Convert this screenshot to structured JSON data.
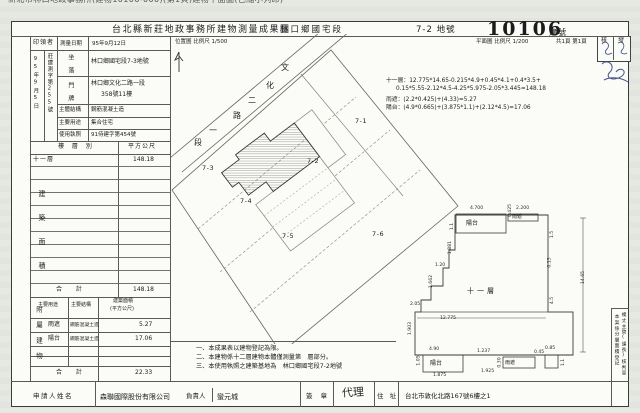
{
  "watermark": "新北市林口地政事務所(建物10106-000)(第1頁)建物平面圖(已縮小列印)",
  "header": {
    "title": "台北縣新莊地政事務所建物測量成果圖",
    "section": "林口鄉國宅段",
    "lot": "7-2 地號",
    "building_no": "10106",
    "building_no_label": "建號"
  },
  "map": {
    "scale_site": "位置圖 比例尺 1/500",
    "scale_plan": "平面圖 比例尺 1/200",
    "pages": "共1頁 第1頁",
    "stamp_left": "核",
    "stamp_right": "發",
    "north_icon": "north-arrow"
  },
  "info": {
    "recipient_label": "印領者",
    "survey_date_label": "測量日期",
    "survey_date": "95年9月12日",
    "receive_date": "95年9月5日",
    "case_no": "莊建測字第255號",
    "site_label": "坐 落",
    "site_value": "林口鄉國宅段7-3地號",
    "addr_label": "門 牌",
    "addr_value1": "林口鄉文化二路一段",
    "addr_value2": "358號11樓",
    "struct_label": "主體結構",
    "struct_value": "鋼筋混凝土造",
    "use_label": "主要用途",
    "use_value": "集合住宅",
    "lic_label": "使用執照",
    "lic_value": "91侍建字第454號"
  },
  "floor_table": {
    "side_label": "建築面積",
    "col_floor": "樓 層 別",
    "col_area": "平方公尺",
    "row_floor": "十一層",
    "row_area": "148.18",
    "total_label": "合 計",
    "total_area": "148.18"
  },
  "annex_table": {
    "side_label": "附屬建物",
    "col_use": "主要用途",
    "col_struct": "主要結構",
    "col_area_1": "建築面積",
    "col_area_2": "(平方公尺)",
    "rows": [
      {
        "use": "雨遮",
        "struct": "鋼筋混凝土造",
        "area": "5.27"
      },
      {
        "use": "陽台",
        "struct": "鋼筋混凝土造",
        "area": "17.06"
      }
    ],
    "total_label": "合 計",
    "total_area": "22.33"
  },
  "formulas": {
    "l1": "十一層：12.775*14.65-0.215*4.9+0.45*4.1+0.4*3.5+",
    "l2": "0.15*5.55-2.12*4.5-4.25*5.975-2.05*3.445=148.18",
    "l3": "雨遮：(2.2*0.425)+(4.33)=5.27",
    "l4": "陽台：(4.9*0.665)+(3.875*1.1)+(2.12*4.5)=17.06"
  },
  "notes": [
    "一、本成果表以建物登記為限。",
    "二、本建物係十二層建物本體僅測量第　層部分。",
    "三、本使用執照之建築基地為　林口鄉國宅段7-2地號"
  ],
  "applicant": {
    "name_label": "申請人姓名",
    "company": "森聯國際股份有限公司",
    "principal_label": "負責人",
    "principal": "蠻元城",
    "sign_label": "簽 章",
    "agent_label": "代理",
    "addr_label": "住 址",
    "addr_value": "台北市敦化北路167號6樓之1"
  },
  "side_box": {
    "col_right": "複丈主管(課長)核判章",
    "col_left": "本案係分層面積登記"
  },
  "siteplan": {
    "road_chars": [
      {
        "t": "文",
        "x": 281,
        "y": 62
      },
      {
        "t": "化",
        "x": 266,
        "y": 80
      },
      {
        "t": "二",
        "x": 248,
        "y": 95
      },
      {
        "t": "路",
        "x": 233,
        "y": 110
      },
      {
        "t": "一",
        "x": 209,
        "y": 125
      },
      {
        "t": "段",
        "x": 194,
        "y": 137
      }
    ],
    "lots": [
      {
        "t": "7-1",
        "x": 355,
        "y": 117
      },
      {
        "t": "7-2",
        "x": 307,
        "y": 157
      },
      {
        "t": "7-3",
        "x": 202,
        "y": 164
      },
      {
        "t": "7-4",
        "x": 240,
        "y": 197
      },
      {
        "t": "7-5",
        "x": 282,
        "y": 232
      },
      {
        "t": "7-6",
        "x": 372,
        "y": 230
      }
    ]
  },
  "floorplan": {
    "labels": [
      {
        "t": "陽台",
        "x": 466,
        "y": 218,
        "fs": 6
      },
      {
        "t": "雨遮",
        "x": 512,
        "y": 213,
        "fs": 5
      },
      {
        "t": "十一層",
        "x": 467,
        "y": 286,
        "fs": 7,
        "ls": 3
      },
      {
        "t": "陽台",
        "x": 430,
        "y": 358,
        "fs": 6
      },
      {
        "t": "雨遮",
        "x": 505,
        "y": 359,
        "fs": 5
      }
    ],
    "dims": [
      {
        "t": "4.700",
        "x": 470,
        "y": 206
      },
      {
        "t": "2.200",
        "x": 516,
        "y": 206
      },
      {
        "t": "0.425",
        "x": 504,
        "y": 208,
        "v": 1
      },
      {
        "t": "1.1",
        "x": 449,
        "y": 224,
        "v": 1
      },
      {
        "t": "1.881",
        "x": 444,
        "y": 245,
        "v": 1
      },
      {
        "t": "1.20",
        "x": 435,
        "y": 263
      },
      {
        "t": "1.662",
        "x": 425,
        "y": 279,
        "v": 1
      },
      {
        "t": "2.05",
        "x": 410,
        "y": 302
      },
      {
        "t": "1.903",
        "x": 404,
        "y": 326,
        "v": 1
      },
      {
        "t": "1.5",
        "x": 549,
        "y": 232,
        "v": 1
      },
      {
        "t": "0.15",
        "x": 545,
        "y": 260,
        "v": 1
      },
      {
        "t": "14.65",
        "x": 577,
        "y": 275,
        "v": 1
      },
      {
        "t": "4.5",
        "x": 549,
        "y": 298,
        "v": 1
      },
      {
        "t": "12.775",
        "x": 440,
        "y": 316
      },
      {
        "t": "4.90",
        "x": 429,
        "y": 347
      },
      {
        "t": "1.875",
        "x": 433,
        "y": 373
      },
      {
        "t": "1.05",
        "x": 414,
        "y": 358,
        "v": 1
      },
      {
        "t": "1.237",
        "x": 477,
        "y": 349
      },
      {
        "t": "1.925",
        "x": 481,
        "y": 369
      },
      {
        "t": "0.30",
        "x": 495,
        "y": 360,
        "v": 1
      },
      {
        "t": "0.45",
        "x": 534,
        "y": 350
      },
      {
        "t": "0.85",
        "x": 545,
        "y": 346
      },
      {
        "t": "1.1",
        "x": 560,
        "y": 360,
        "v": 1
      }
    ]
  }
}
